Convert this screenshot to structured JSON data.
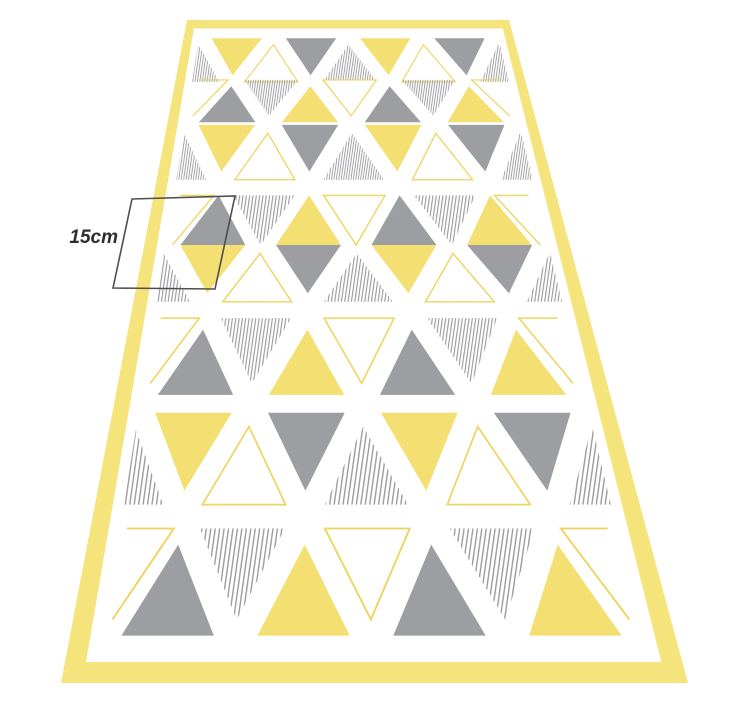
{
  "annotation": {
    "label": "15cm",
    "line_color": "#4f4f4f",
    "text_color": "#2e2e2e",
    "box_points": "132,199 235,196 215,289 113,288",
    "label_x": 118,
    "label_y": 243,
    "label_size": 19
  },
  "rug": {
    "colors": {
      "yellow": "#F4DF72",
      "border_yellow": "#F5E37C",
      "gray": "#9D9EA2",
      "stripe_gray": "#9B9CA0",
      "outline_yellow": "#EFD35C",
      "white": "#FFFFFF"
    },
    "pattern": {
      "stripe_angle": 8,
      "stripe_groups": {
        "fine": {
          "spacing": 2.4,
          "line": 0.9
        },
        "med": {
          "spacing": 3.3,
          "line": 1.15
        },
        "coarse": {
          "spacing": 4.4,
          "line": 1.4
        }
      },
      "row_types": {
        "A": [
          "st-u",
          "y-d",
          "o-u",
          "g-d",
          "st-u",
          "y-d",
          "o-u",
          "g-d",
          "st-u"
        ],
        "B": [
          "c7-d",
          "g-u",
          "st-d",
          "y-u",
          "o-d",
          "g-u",
          "st-d",
          "y-u",
          "cl-d"
        ]
      },
      "rows": [
        {
          "u0": 0.052,
          "u1": 0.167,
          "type": "A",
          "stripe": "fine"
        },
        {
          "u0": 0.162,
          "u1": 0.262,
          "type": "B",
          "stripe": "fine"
        },
        {
          "u0": 0.268,
          "u1": 0.382,
          "type": "A",
          "stripe": "fine"
        },
        {
          "u0": 0.412,
          "u1": 0.5,
          "type": "B",
          "stripe": "med",
          "diamond": true
        },
        {
          "u0": 0.5,
          "u1": 0.59,
          "type": "A",
          "stripe": "med"
        },
        {
          "u0": 0.614,
          "u1": 0.717,
          "type": "B",
          "stripe": "med"
        },
        {
          "u0": 0.739,
          "u1": 0.841,
          "type": "A",
          "stripe": "coarse"
        },
        {
          "u0": 0.865,
          "u1": 0.962,
          "type": "B",
          "stripe": "coarse"
        }
      ]
    },
    "geometry": {
      "top_y": 20,
      "height": 663,
      "top_left_x": 187,
      "top_right_x": 509,
      "bottom_left_x": 61,
      "bottom_right_x": 688,
      "top_width": 322,
      "bottom_width": 627,
      "border_top": 8.5,
      "border_bottom": 21,
      "clip_extra_top": 7,
      "clip_extra_bottom": 12,
      "slot_f0": 0.049,
      "slot_df": 0.1123,
      "tri_half": 0.0763,
      "down_frac": 0.85,
      "up_shift": 0.15
    }
  }
}
